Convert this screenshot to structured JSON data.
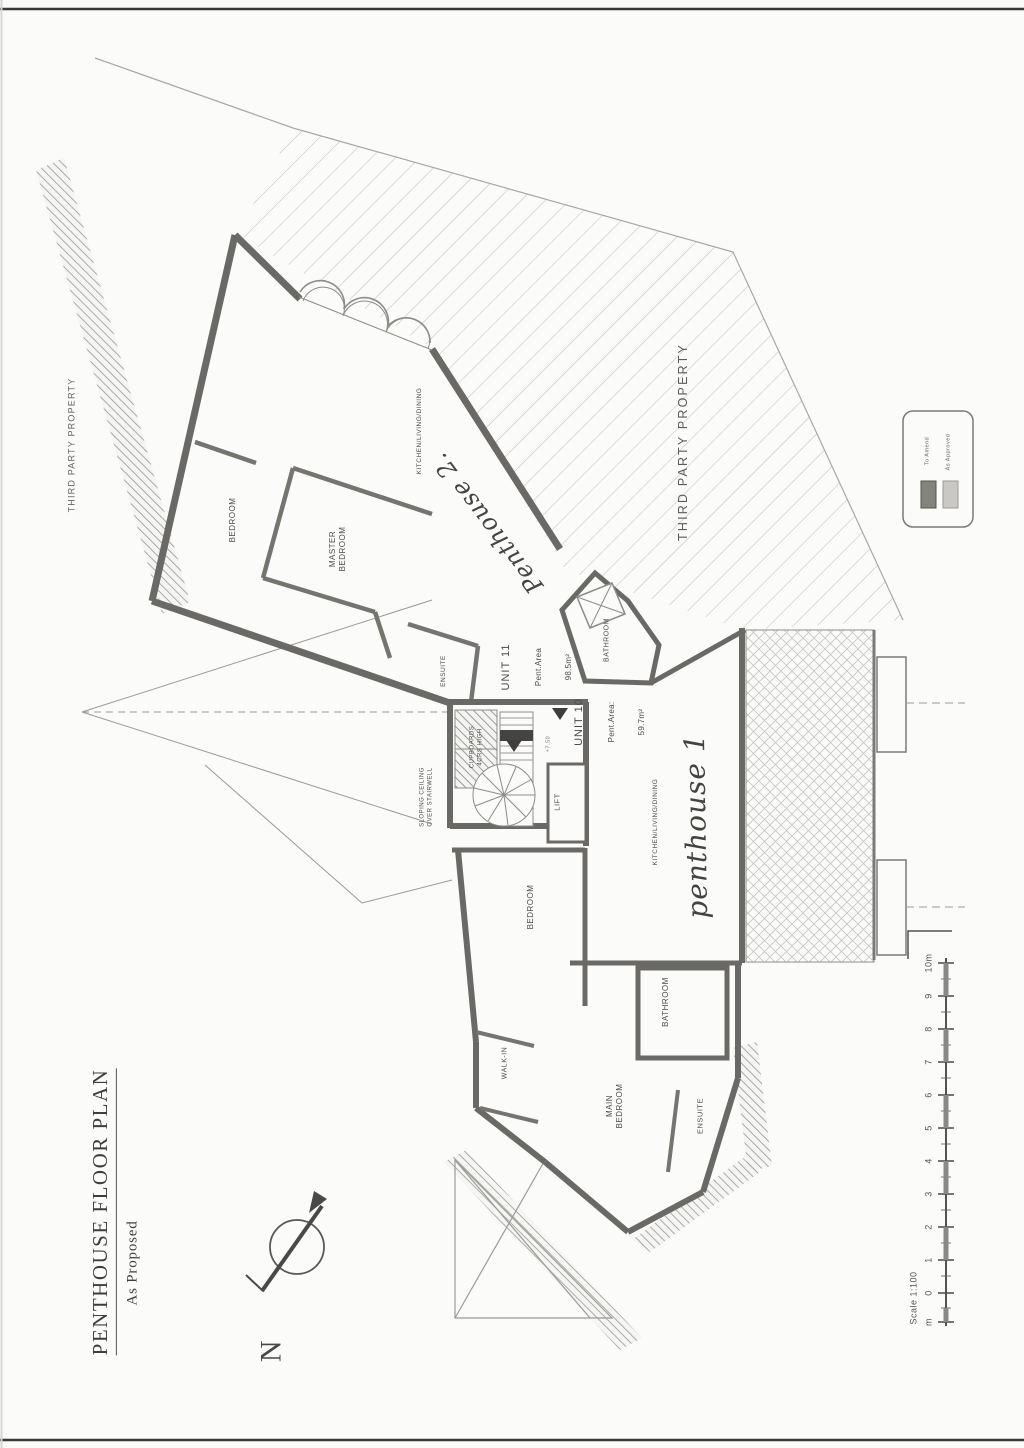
{
  "document": {
    "title": "PENTHOUSE FLOOR PLAN",
    "subtitle": "As Proposed"
  },
  "compass": {
    "north_label": "N"
  },
  "site": {
    "third_party_left": "THIRD PARTY PROPERTY",
    "third_party_right": "THIRD PARTY PROPERTY"
  },
  "legend": {
    "to_amend": {
      "label": "To Amend",
      "color": "#85837e"
    },
    "as_approved": {
      "label": "As Approved",
      "color": "#c9c8c4"
    }
  },
  "scalebar": {
    "caption": "Scale 1:100",
    "labels": [
      "m",
      "0",
      "1",
      "2",
      "3",
      "4",
      "5",
      "6",
      "7",
      "8",
      "9",
      "10m"
    ]
  },
  "unit11": {
    "name": "UNIT 11",
    "area_label": "Pent.Area",
    "area_value": "98.5m²",
    "handwritten": "Penthouse 2.",
    "rooms": {
      "kitchen": "KITCHEN/LIVING/DINING",
      "bedroom": "BEDROOM",
      "master_bedroom": "MASTER\nBEDROOM",
      "ensuite": "ENSUITE",
      "bathroom": "BATHROOM"
    }
  },
  "unit10": {
    "name": "UNIT 10",
    "area_label": "Pent.Area:",
    "area_value": "59.7m²",
    "handwritten": "penthouse 1",
    "rooms": {
      "kitchen": "KITCHEN/LIVING/DINING",
      "bedroom": "BEDROOM",
      "walk_in": "WALK-IN",
      "bathroom": "BATHROOM",
      "main_bedroom": "MAIN\nBEDROOM",
      "ensuite": "ENSUITE"
    }
  },
  "annotations": {
    "sloping_ceiling": "SLOPING CEILING\nOVER STAIRWELL",
    "cupboards": "CUPBOARDS\n4CRS HIGH",
    "lift": "LIFT",
    "level": "+7.50"
  }
}
